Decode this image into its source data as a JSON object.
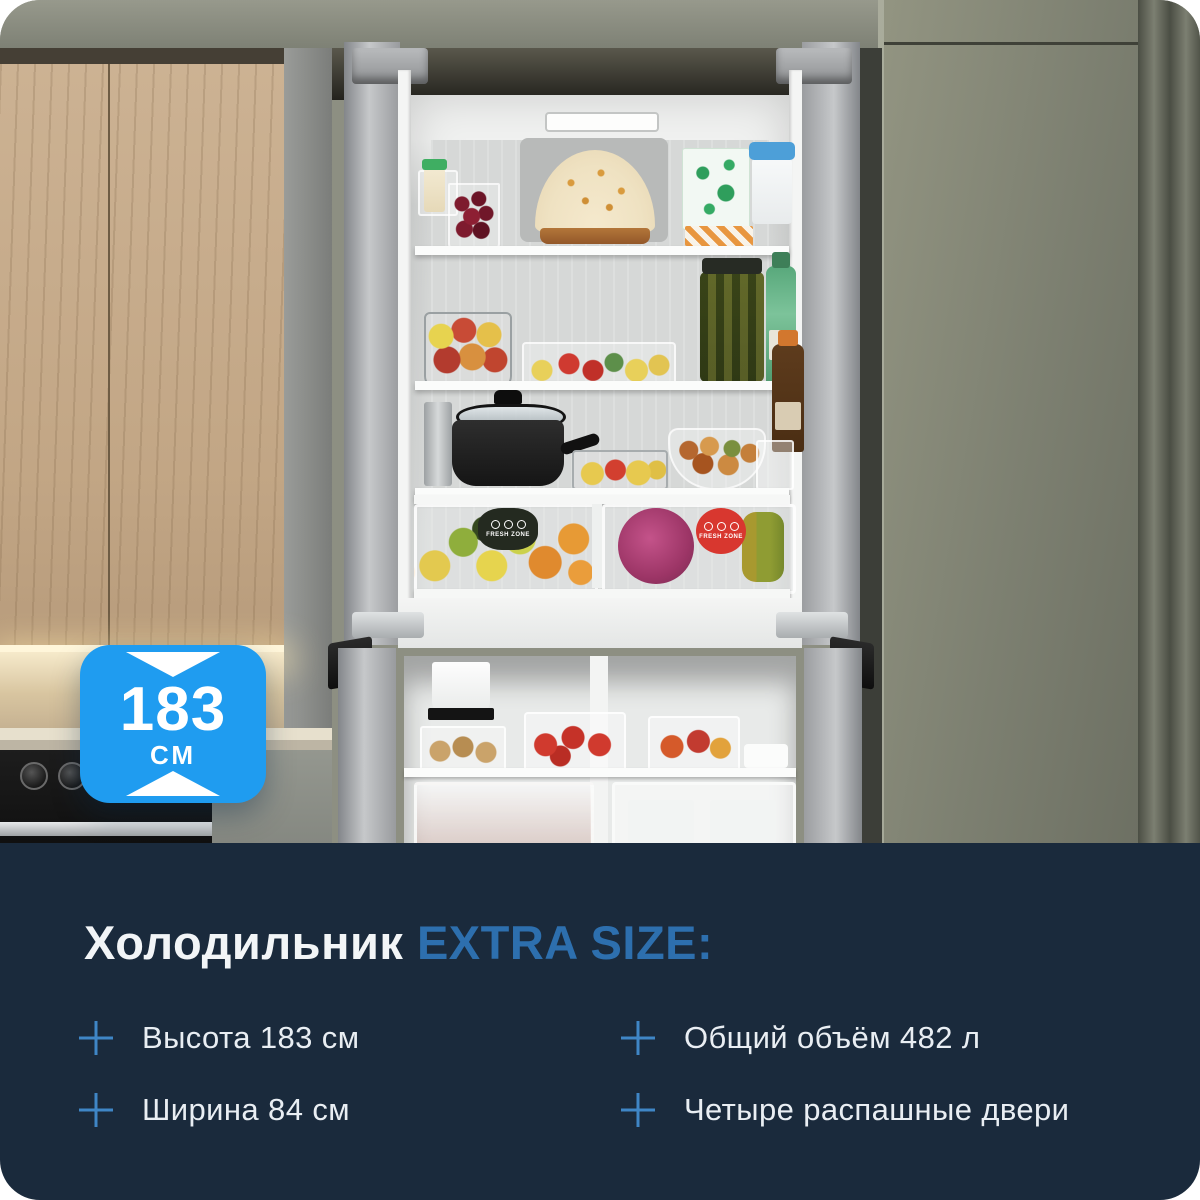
{
  "card": {
    "badge": {
      "value": "183",
      "unit": "см"
    },
    "fridge": {
      "fresh_zone_left": "FRESH ZONE",
      "fresh_zone_right": "FRESH ZONE"
    },
    "panel": {
      "title": {
        "product": "Холодильник",
        "accent": "EXTRA SIZE:"
      },
      "features": [
        {
          "label": "Высота 183 см"
        },
        {
          "label": "Ширина 84 см"
        },
        {
          "label": "Общий объём 482 л"
        },
        {
          "label": "Четыре распашные двери"
        }
      ]
    },
    "colors": {
      "badge_blue": "#1f9cf0",
      "accent_blue": "#2d6fae",
      "plus_icon_blue": "#3f86c6",
      "panel_background": "#1a2a3c",
      "title_white": "#f2f5f7"
    }
  }
}
